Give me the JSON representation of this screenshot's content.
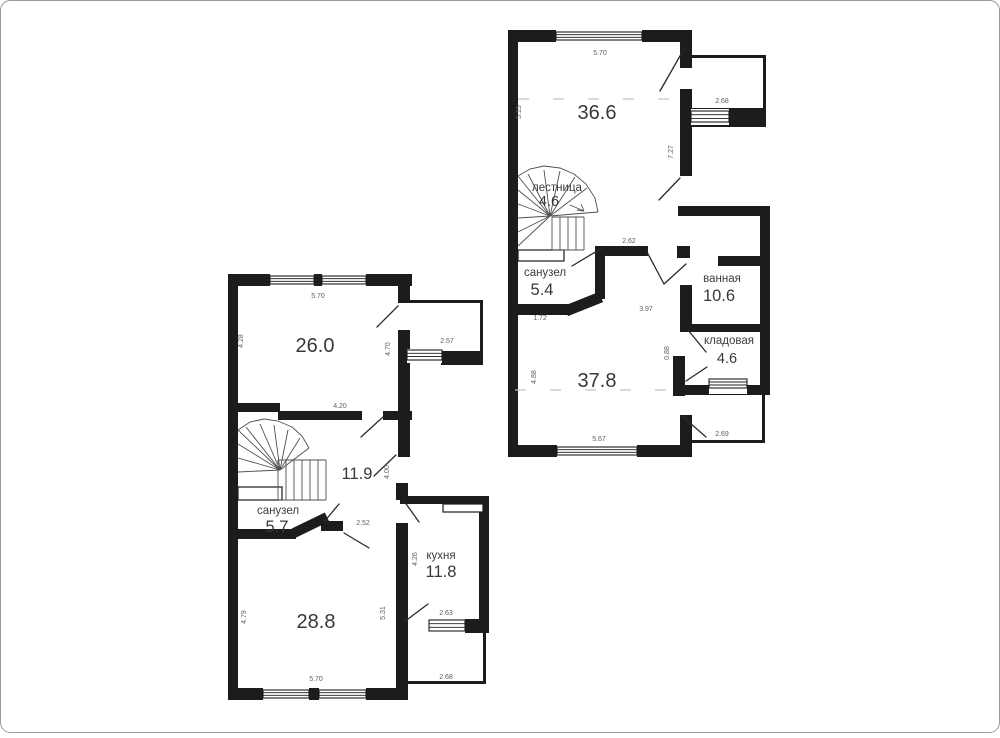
{
  "floor2": {
    "rooms": {
      "room1": {
        "area": "36.6"
      },
      "stairs": {
        "label": "лестница",
        "area": "4.6"
      },
      "wc": {
        "label": "санузел",
        "area": "5.4"
      },
      "bath": {
        "label": "ванная",
        "area": "10.6"
      },
      "storage": {
        "label": "кладовая",
        "area": "4.6"
      },
      "room2": {
        "area": "37.8"
      }
    },
    "dims": {
      "top": "5.70",
      "left_top": "5.15",
      "right_top": "7.27",
      "balcony_top": "2.68",
      "hall_opening": "2.62",
      "wc_bottom": "1.72",
      "hall_height": "3.97",
      "storage_left": "0.88",
      "room2_left": "4.88",
      "bottom": "5.67",
      "balcony_bottom": "2.69"
    }
  },
  "floor1": {
    "rooms": {
      "living": {
        "area": "26.0"
      },
      "hall": {
        "area": "11.9"
      },
      "wc": {
        "label": "санузел",
        "area": "5.7"
      },
      "kitchen": {
        "label": "кухня",
        "area": "11.8"
      },
      "room2": {
        "area": "28.8"
      }
    },
    "dims": {
      "top": "5.70",
      "living_left": "4.28",
      "living_right": "4.70",
      "balcony_right": "2.57",
      "living_bottom": "4.20",
      "hall_right": "4.00",
      "vestibule": "2.52",
      "kitchen_left": "4.26",
      "room2_left": "4.79",
      "room2_right": "5.31",
      "balcony_window": "2.63",
      "bottom": "5.70",
      "balcony_bottom": "2.68"
    }
  }
}
